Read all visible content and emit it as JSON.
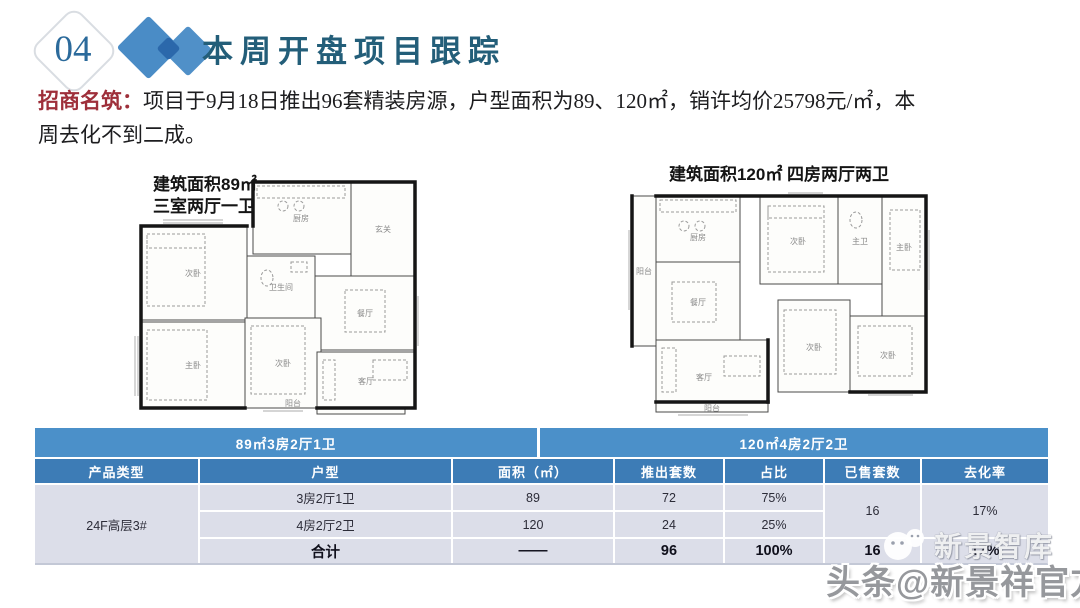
{
  "header": {
    "section_number": "04",
    "title": "本周开盘项目跟踪"
  },
  "intro": {
    "project_name": "招商名筑：",
    "line1": "项目于9月18日推出96套精装房源，户型面积为89、120㎡，销许均价25798元/㎡，本",
    "line2": "周去化不到二成。"
  },
  "floorplans": [
    {
      "title_line1": "建筑面积89㎡",
      "title_line2": "三室两厅一卫",
      "rooms": [
        "厨房",
        "玄关",
        "次卧",
        "卫生间",
        "餐厅",
        "主卧",
        "次卧",
        "客厅",
        "阳台"
      ]
    },
    {
      "title": "建筑面积120㎡ 四房两厅两卫",
      "rooms": [
        "阳台",
        "厨房",
        "餐厅",
        "客厅",
        "阳台",
        "次卧",
        "主卫",
        "主卧",
        "次卧",
        "次卧"
      ]
    }
  ],
  "table": {
    "span_headers": {
      "left": "89㎡3房2厅1卫",
      "right": "120㎡4房2厅2卫"
    },
    "columns": {
      "product": "产品类型",
      "huxing": "户型",
      "area": "面积（㎡）",
      "units": "推出套数",
      "share": "占比",
      "sold": "已售套数",
      "rate": "去化率"
    },
    "product_type": "24F高层3#",
    "rows": [
      {
        "huxing": "3房2厅1卫",
        "area": "89",
        "units": "72",
        "share": "75%"
      },
      {
        "huxing": "4房2厅2卫",
        "area": "120",
        "units": "24",
        "share": "25%"
      }
    ],
    "merged_sold": "16",
    "merged_rate": "17%",
    "total": {
      "label": "合计",
      "area": "——",
      "units": "96",
      "share": "100%",
      "sold": "16",
      "rate": "17%"
    }
  },
  "watermark": {
    "brand": "新景智库",
    "handle": "头条@新景祥官方"
  },
  "colors": {
    "span_header_bg": "#4b90c9",
    "column_header_bg": "#3d7cb6",
    "row_bg": "#dcdee9",
    "accent_red": "#9e2f3a",
    "title_color": "#235e79",
    "diamond_blue": "#4a8cc6",
    "diamond_dark": "#2b68ab"
  }
}
